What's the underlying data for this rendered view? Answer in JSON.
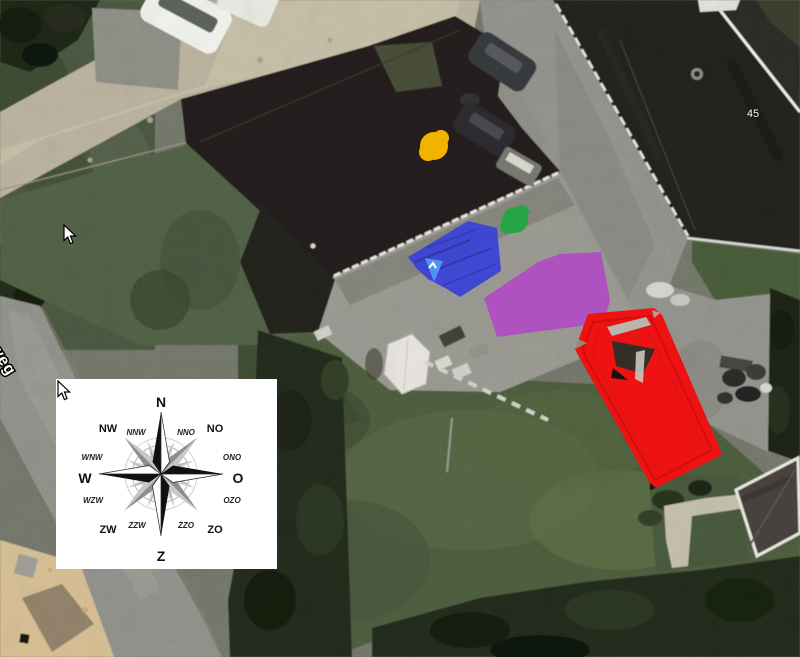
{
  "map": {
    "house_number": "45",
    "street_label": "weg"
  },
  "compass": {
    "points": [
      {
        "label": "N"
      },
      {
        "label": "NNO"
      },
      {
        "label": "NO"
      },
      {
        "label": "ONO"
      },
      {
        "label": "O"
      },
      {
        "label": "OZO"
      },
      {
        "label": "ZO"
      },
      {
        "label": "ZZO"
      },
      {
        "label": "Z"
      },
      {
        "label": "ZZW"
      },
      {
        "label": "ZW"
      },
      {
        "label": "WZW"
      },
      {
        "label": "W"
      },
      {
        "label": "WNW"
      },
      {
        "label": "NW"
      },
      {
        "label": "NNW"
      }
    ]
  },
  "annotations": {
    "yellow_dot": {
      "color": "#f2b300",
      "cx": "434",
      "cy": "146",
      "r": "14"
    },
    "green_dot": {
      "color": "#28a447",
      "cx": "515",
      "cy": "220",
      "r": "13"
    },
    "blue_area": {
      "color": "#3b42d6",
      "points": "408,257 468,221 497,228 501,271 460,297 445,288 428,279 417,269"
    },
    "blue_pin": {
      "color": "#4f92f0",
      "points": "425,258 443,261 434,282"
    },
    "purple_area": {
      "color": "#b14cc4",
      "points": "484,298 538,262 560,254 601,252 610,300 604,323 497,337"
    },
    "red_area": {
      "color": "#ee1212",
      "points": "575,349 588,314 654,308 662,315 718,444 722,455 653,489 578,355"
    }
  },
  "cursors": [
    {
      "x": "63",
      "y": "224"
    },
    {
      "x": "57",
      "y": "380"
    }
  ]
}
